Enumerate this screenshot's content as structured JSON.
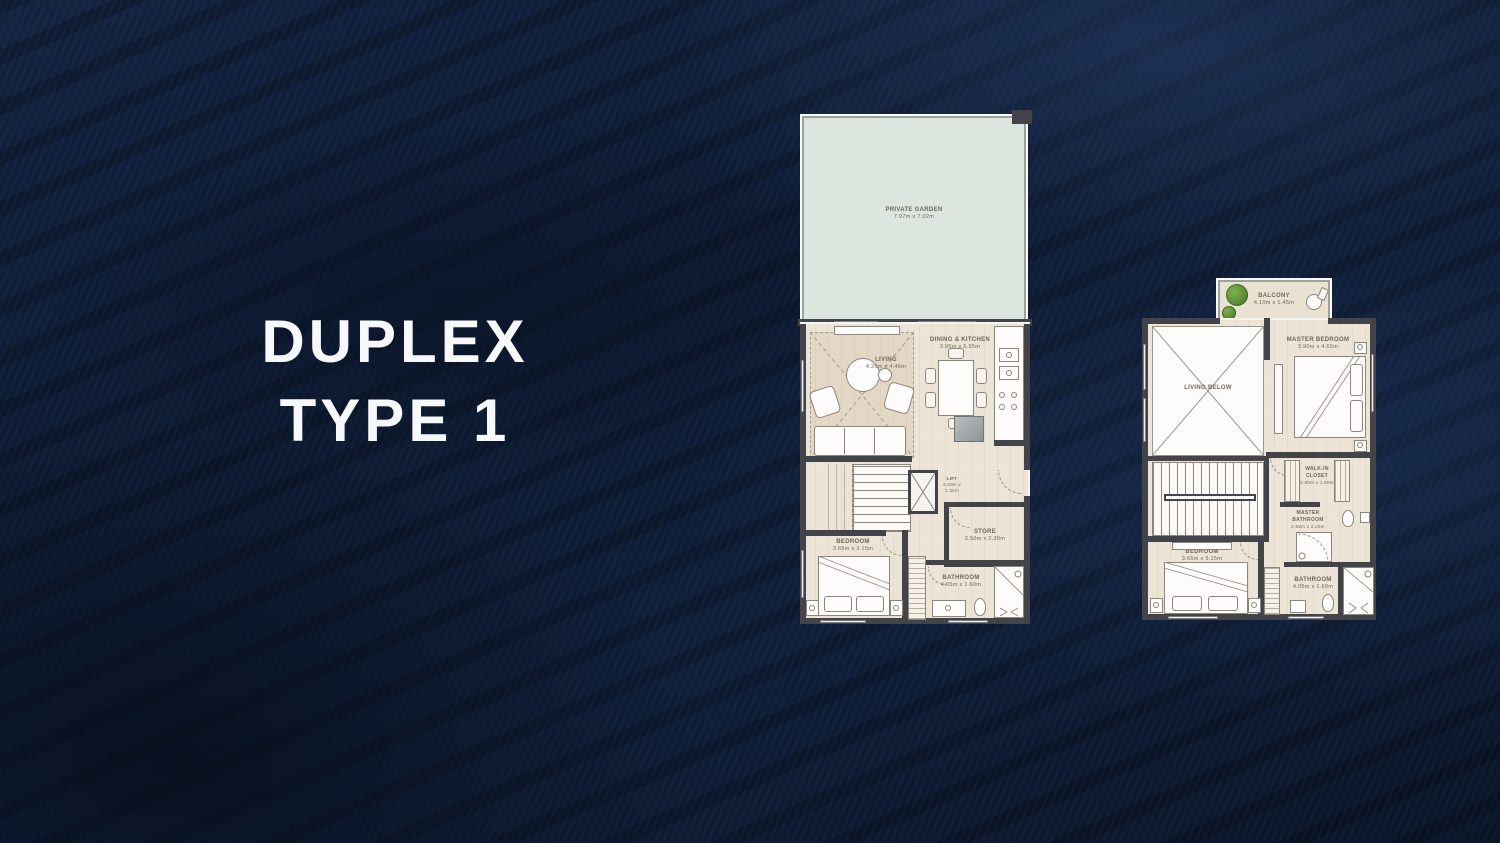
{
  "title": {
    "line1": "DUPLEX",
    "line2": "TYPE 1"
  },
  "colors": {
    "background_navy": "#0d1a30",
    "floor_beige": "#ece4d6",
    "garden_green": "#dce6de",
    "wall_gray": "#43444a",
    "label_brown": "#6f675b",
    "title_white": "#f7f8fa",
    "plant_green": "#5d8f37"
  },
  "plans": {
    "lower": {
      "name": "Lower Level",
      "rooms": [
        {
          "label": "PRIVATE GARDEN",
          "dims": "7.97m x 7.02m"
        },
        {
          "label": "LIVING",
          "dims": "4.26m x 4.46m"
        },
        {
          "label": "DINING & KITCHEN",
          "dims": "3.95m x 6.55m"
        },
        {
          "label": "LIFT",
          "dims": "2.00m x 1.35m"
        },
        {
          "label": "STORE",
          "dims": "2.50m x 2.30m"
        },
        {
          "label": "BEDROOM",
          "dims": "3.65m x 3.15m"
        },
        {
          "label": "BATHROOM",
          "dims": "4.05m x 1.60m"
        }
      ]
    },
    "upper": {
      "name": "Upper Level",
      "rooms": [
        {
          "label": "BALCONY",
          "dims": "4.10m x 1.45m"
        },
        {
          "label": "LIVING BELOW",
          "dims": ""
        },
        {
          "label": "MASTER BEDROOM",
          "dims": "3.90m x 4.65m"
        },
        {
          "label": "WALK-IN CLOSET",
          "dims": "2.80m x 1.60m"
        },
        {
          "label": "MASTER BATHROOM",
          "dims": "2.65m x 2.25m"
        },
        {
          "label": "BEDROOM",
          "dims": "3.65m x 3.15m"
        },
        {
          "label": "BATHROOM",
          "dims": "4.05m x 1.60m"
        }
      ]
    }
  }
}
